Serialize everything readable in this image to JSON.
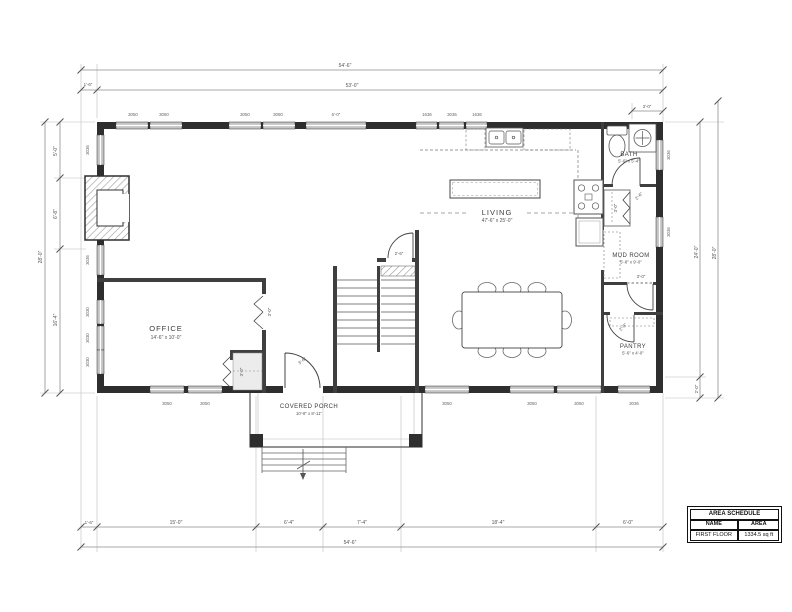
{
  "rooms": [
    {
      "name": "LIVING",
      "size": "47'-6\" x 25'-0\""
    },
    {
      "name": "OFFICE",
      "size": "14'-6\" x 10'-0\""
    },
    {
      "name": "BATH",
      "size": "5'-6\" x 5'-4\""
    },
    {
      "name": "MUD ROOM",
      "size": "5'-8\" x 9'-0\""
    },
    {
      "name": "PANTRY",
      "size": "5'-6\" x 4'-0\""
    },
    {
      "name": "COVERED PORCH",
      "size": "10'-8\" x 8'-11\""
    }
  ],
  "dims": {
    "top_overall": "54'-6\"",
    "top_main": "53'-0\"",
    "top_offset": "1'-6\"",
    "vanity": "3'-0\"",
    "bottom": [
      "1'-6\"",
      "15'-0\"",
      "6'-4\"",
      "7'-4\"",
      "18'-4\"",
      "6'-0\""
    ],
    "bottom_overall": "54'-6\"",
    "left": [
      "5'-0\"",
      "6'-8\"",
      "16'-4\""
    ],
    "left_overall": "28'-0\"",
    "right": [
      "24'-0\"",
      "2'-0\""
    ],
    "right_overall": "28'-0\""
  },
  "windows": {
    "top": [
      "3050",
      "3050",
      "3050",
      "3050",
      "6'-0\"",
      "1636",
      "3036",
      "1636"
    ],
    "left": [
      "3036",
      "3036",
      "3030",
      "3030",
      "3030"
    ],
    "right": [
      "3036",
      "3036"
    ],
    "bottom": [
      "3050",
      "3050",
      "3050",
      "3050",
      "3050",
      "3036"
    ]
  },
  "doors": {
    "entry": "3'-6\"",
    "office": "3'-0\"",
    "office_closet": "3'-0\"",
    "stair": "2'-6\"",
    "bath": "2'-6\"",
    "hall_closet": "3'-0\"",
    "mud_room": "3'-0\"",
    "pantry": "2'-8\""
  },
  "area_schedule": {
    "title": "AREA SCHEDULE",
    "columns": [
      "NAME",
      "AREA"
    ],
    "rows": [
      {
        "name": "FIRST FLOOR",
        "area": "1334.5 sq ft"
      }
    ]
  }
}
